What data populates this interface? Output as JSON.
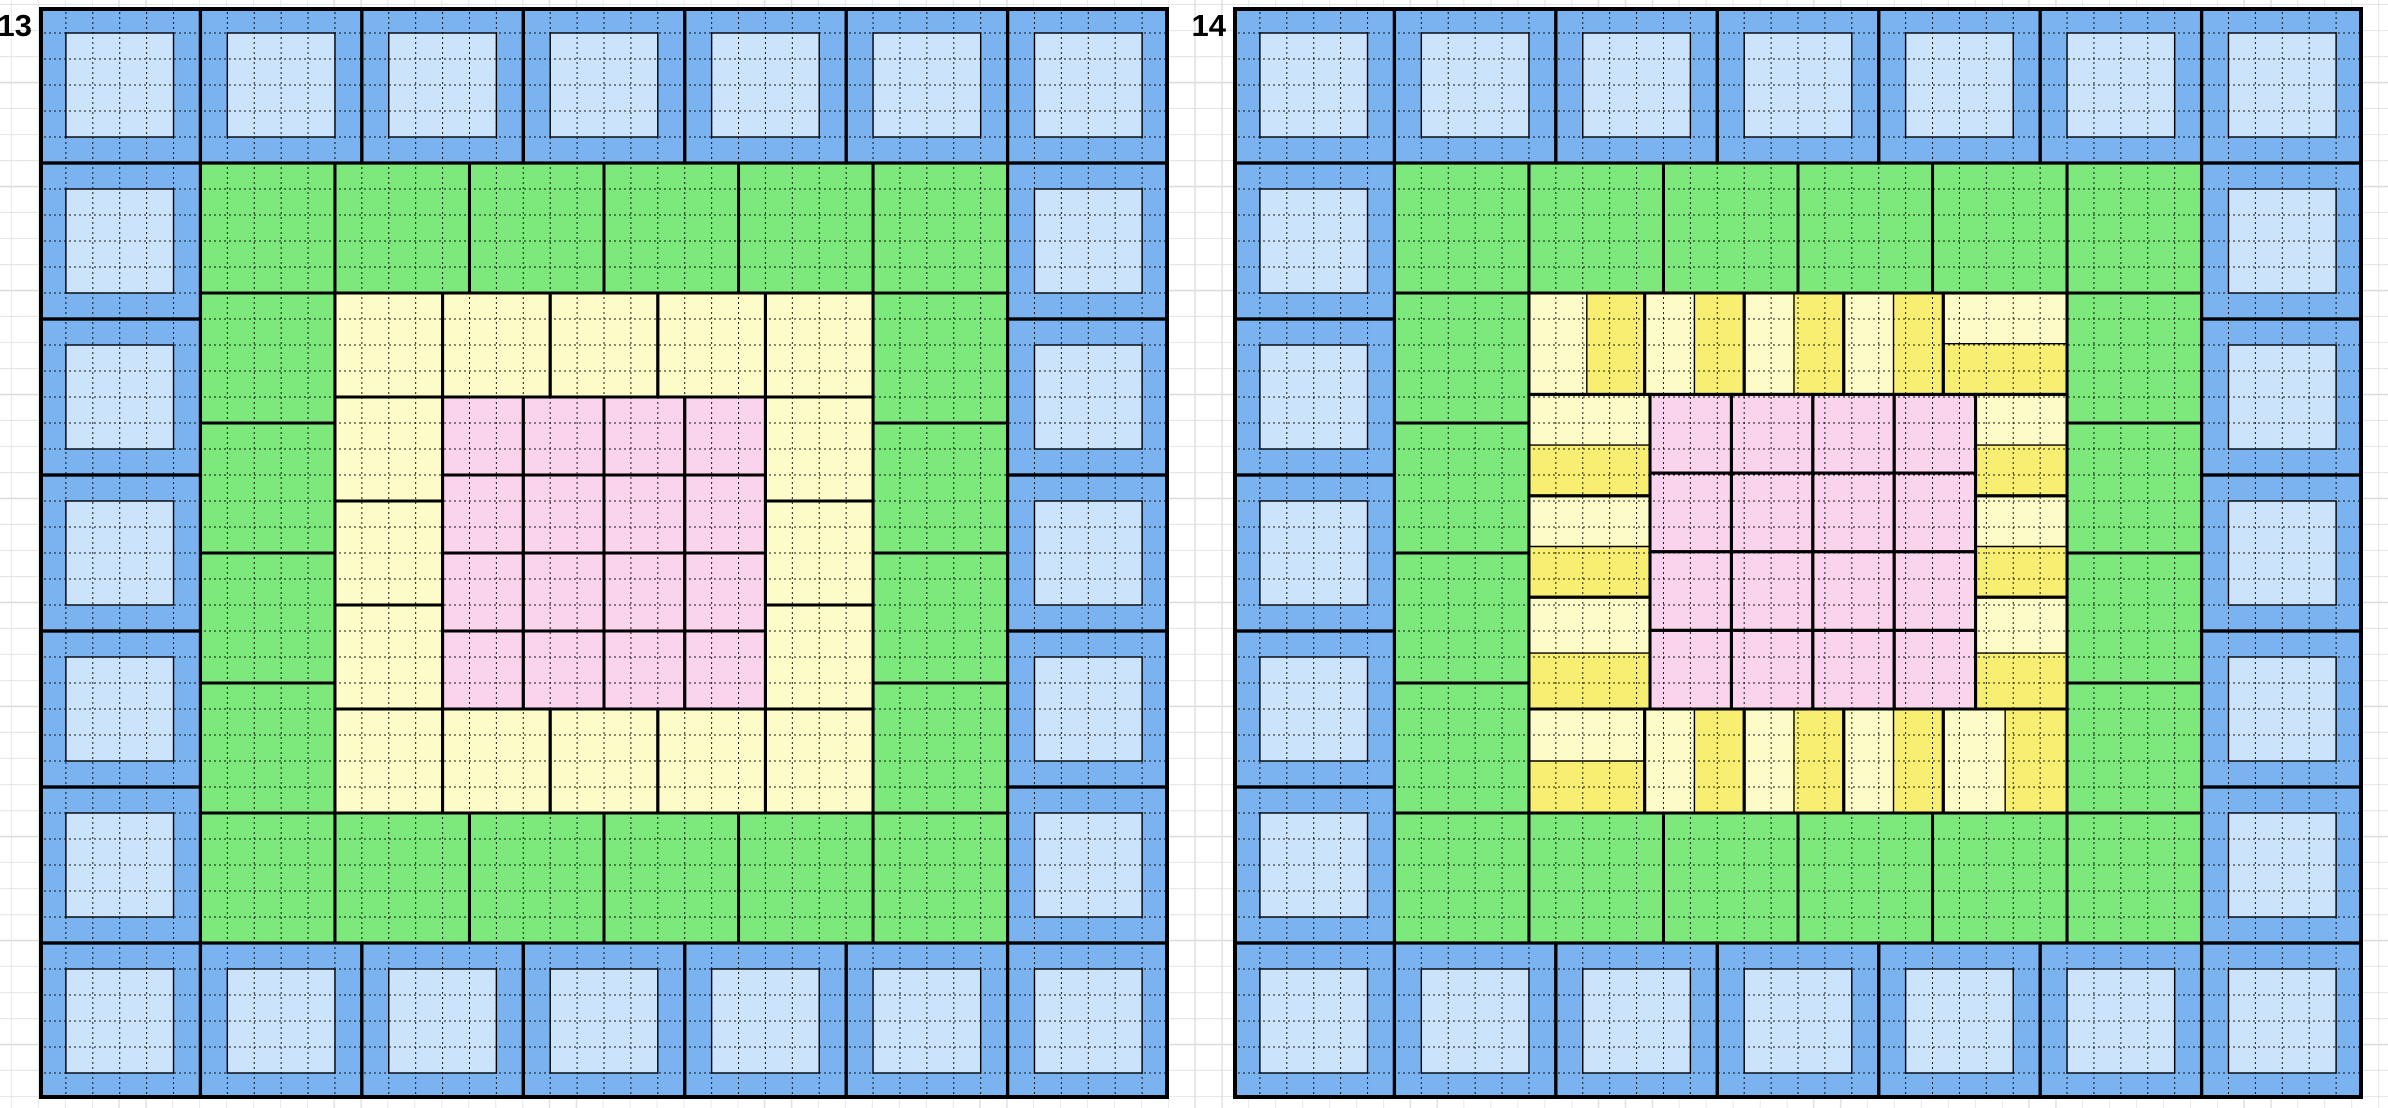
{
  "page": {
    "background": "#ffffff",
    "sheet_grid": {
      "row_height": 26,
      "col_width": 26.9,
      "line_color": "#dcdcdc"
    }
  },
  "colors": {
    "blue_mid": "#7ab3f0",
    "blue_light": "#cbe3fb",
    "green": "#7de97d",
    "yellow_pale": "#fdfbc8",
    "yellow_bright": "#f8ee72",
    "pink": "#fad3ec",
    "line": "#000000"
  },
  "grid": {
    "cols": 42,
    "rows": 42,
    "cell_w": 26.905,
    "cell_h": 26
  },
  "figures": [
    {
      "label": "13",
      "x": 39,
      "y": 7,
      "blue_ring": {
        "tiles_per_side": 7,
        "tile_cells": 6,
        "inner_offset": 1,
        "inner_cells": 4
      },
      "green_ring": {
        "start": 6,
        "tiles_per_side": 6,
        "tile_cells": 5
      },
      "yellow_tiles": [
        [
          11,
          11,
          4,
          4,
          ""
        ],
        [
          15,
          11,
          4,
          4,
          ""
        ],
        [
          19,
          11,
          4,
          4,
          ""
        ],
        [
          23,
          11,
          4,
          4,
          ""
        ],
        [
          27,
          11,
          4,
          4,
          ""
        ],
        [
          11,
          27,
          4,
          4,
          ""
        ],
        [
          15,
          27,
          4,
          4,
          ""
        ],
        [
          19,
          27,
          4,
          4,
          ""
        ],
        [
          23,
          27,
          4,
          4,
          ""
        ],
        [
          27,
          27,
          4,
          4,
          ""
        ],
        [
          11,
          15,
          4,
          4,
          ""
        ],
        [
          11,
          19,
          4,
          4,
          ""
        ],
        [
          11,
          23,
          4,
          4,
          ""
        ],
        [
          27,
          15,
          4,
          4,
          ""
        ],
        [
          27,
          19,
          4,
          4,
          ""
        ],
        [
          27,
          23,
          4,
          4,
          ""
        ]
      ],
      "pink_block": {
        "x0": 15,
        "y0": 15,
        "nx": 4,
        "ny": 4,
        "pitch_x": 3,
        "pitch_y": 3
      }
    },
    {
      "label": "14",
      "x": 1233,
      "y": 7,
      "blue_ring": {
        "tiles_per_side": 7,
        "tile_cells": 6,
        "inner_offset": 1,
        "inner_cells": 4
      },
      "green_ring": {
        "start": 6,
        "tiles_per_side": 6,
        "tile_cells": 5
      },
      "yellow_tiles": [
        [
          11,
          11,
          4.3,
          3.9,
          "v"
        ],
        [
          15.3,
          11,
          3.7,
          3.9,
          "v"
        ],
        [
          19,
          11,
          3.7,
          3.9,
          "v"
        ],
        [
          22.7,
          11,
          3.7,
          3.9,
          "v"
        ],
        [
          26.4,
          11,
          4.6,
          3.9,
          "h"
        ],
        [
          11,
          27,
          4.3,
          4,
          "h"
        ],
        [
          15.3,
          27,
          3.7,
          4,
          "v"
        ],
        [
          19,
          27,
          3.7,
          4,
          "v"
        ],
        [
          22.7,
          27,
          3.7,
          4,
          "v"
        ],
        [
          26.4,
          27,
          4.6,
          4,
          "v"
        ],
        [
          11,
          14.9,
          4.5,
          3.9,
          "h"
        ],
        [
          11,
          18.8,
          4.5,
          3.9,
          "h"
        ],
        [
          11,
          22.7,
          4.5,
          4.3,
          "h"
        ],
        [
          27.6,
          14.9,
          3.4,
          3.9,
          "h"
        ],
        [
          27.6,
          18.8,
          3.4,
          3.9,
          "h"
        ],
        [
          27.6,
          22.7,
          3.4,
          4.3,
          "h"
        ]
      ],
      "pink_block": {
        "x0": 15.5,
        "y0": 14.9,
        "nx": 4,
        "ny": 4,
        "pitch_x": 3.025,
        "pitch_y": 3.025
      }
    }
  ]
}
